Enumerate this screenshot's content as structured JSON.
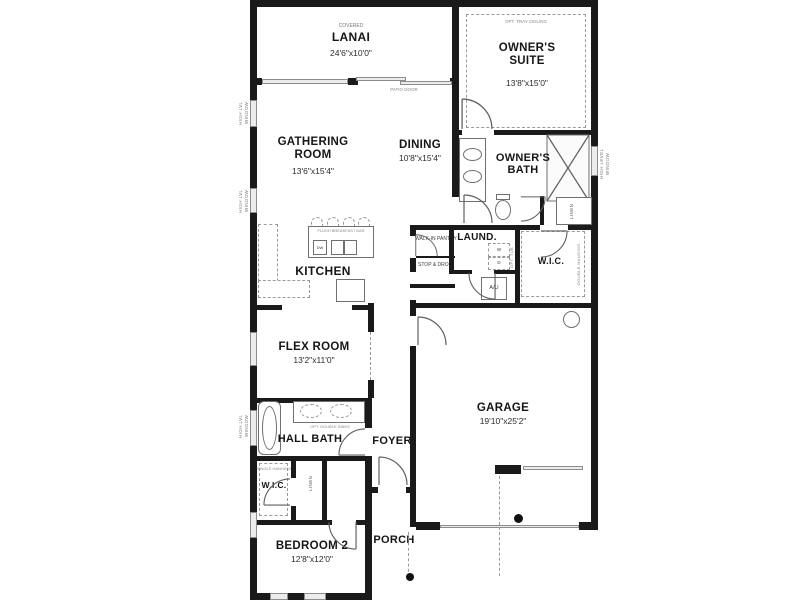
{
  "rooms": {
    "lanai": {
      "qualifier": "COVERED",
      "name": "LANAI",
      "dims": "24'6\"x10'0\""
    },
    "owners_suite": {
      "option": "OPT. TRAY CEILING",
      "name": "OWNER'S SUITE",
      "dims": "13'8\"x15'0\""
    },
    "gathering_room": {
      "name": "GATHERING ROOM",
      "dims": "13'6\"x15'4\""
    },
    "dining": {
      "name": "DINING",
      "dims": "10'8\"x15'4\""
    },
    "owners_bath": {
      "name": "OWNER'S BATH"
    },
    "kitchen": {
      "name": "KITCHEN"
    },
    "laundry": {
      "name": "LAUND."
    },
    "owners_wic": {
      "name": "W.I.C.",
      "note": "DOUBLE HANGING"
    },
    "pantry": {
      "name": "WALK-IN PANTRY"
    },
    "stop_and_drop": {
      "name": "STOP & DROP"
    },
    "flex_room": {
      "name": "FLEX ROOM",
      "dims": "13'2\"x11'0\""
    },
    "garage": {
      "name": "GARAGE",
      "dims": "19'10\"x25'2\""
    },
    "foyer": {
      "name": "FOYER"
    },
    "hall_bath": {
      "name": "HALL BATH",
      "option": "OPT. DOUBLE SINKS"
    },
    "bedroom2_wic": {
      "name": "W.I.C.",
      "note": "SINGLE HANGING"
    },
    "linen_hall": {
      "name": "LINEN"
    },
    "linen_bath": {
      "name": "LINEN"
    },
    "bedroom2": {
      "name": "BEDROOM 2",
      "dims": "12'8\"x12'0\""
    },
    "porch": {
      "name": "PORCH"
    }
  },
  "annotations": {
    "patio_door": "PATIO DOOR",
    "flush_breakfast_bar": "FLUSH BREAKFAST BAR",
    "dishwasher": "DW",
    "washer": "W",
    "dryer": "D",
    "air_unit": "A/U",
    "opt_tub": "OPT. TUB",
    "high_lvl_window": "HIGH LVL WINDOW",
    "high_level_window": "HIGH LEVEL WINDOW"
  },
  "colors": {
    "wall": "#1a1a1a",
    "window_fill": "#ececec",
    "dash_line": "#9a9a9a"
  }
}
